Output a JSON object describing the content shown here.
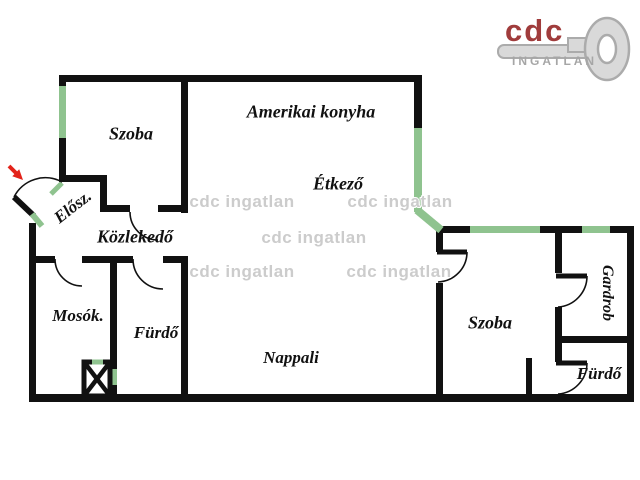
{
  "logo": {
    "brand": "cdc",
    "subtitle": "INGATLAN",
    "brand_color": "#a03c3c",
    "subtitle_color": "#a6a6a6",
    "key_color": "#d9d9d9"
  },
  "watermark": {
    "text": "cdc ingatlan",
    "color": "#cccccc"
  },
  "colors": {
    "wall": "#111111",
    "window": "#8fc38f",
    "entrance_arrow": "#e3231a",
    "background": "#ffffff"
  },
  "rooms": [
    {
      "id": "szoba-topleft",
      "label": "Szoba"
    },
    {
      "id": "amerikai-konyha",
      "label": "Amerikai konyha"
    },
    {
      "id": "etkezo",
      "label": "Étkező"
    },
    {
      "id": "elosz",
      "label": "Elősz."
    },
    {
      "id": "kozlekedo",
      "label": "Közlekedő"
    },
    {
      "id": "mosok",
      "label": "Mosók."
    },
    {
      "id": "furdo-left",
      "label": "Fürdő"
    },
    {
      "id": "nappali",
      "label": "Nappali"
    },
    {
      "id": "szoba-right",
      "label": "Szoba"
    },
    {
      "id": "gardrob",
      "label": "Gardrob"
    },
    {
      "id": "furdo-right",
      "label": "Fürdő"
    }
  ]
}
